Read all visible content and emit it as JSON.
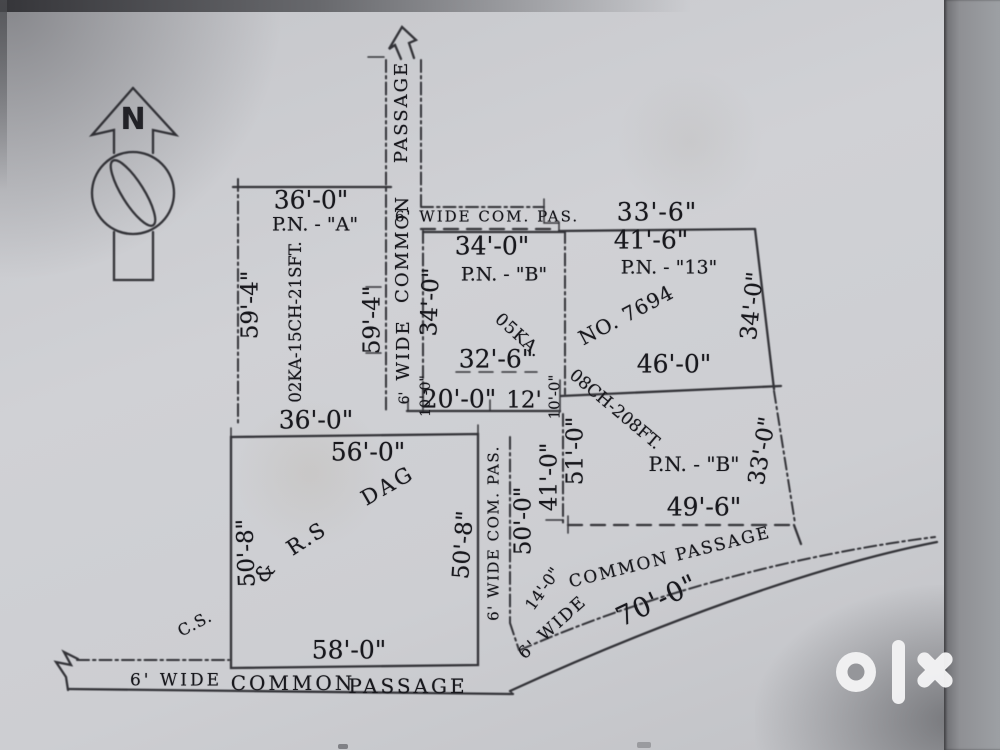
{
  "north": {
    "letter": "N"
  },
  "strip_top": {
    "p1": "PASSAGE",
    "p2": "COMMON",
    "p3": "WIDE",
    "p4": "6'"
  },
  "passage_top": {
    "label": "6' WIDE COM. PAS.",
    "dim": "33'-6\""
  },
  "plot_a": {
    "top": "36'-0\"",
    "name": "P.N. - \"A\"",
    "left": "59'-4\"",
    "area": "02KA-15CH-21SFT.",
    "right": "59'-4\"",
    "bottom": "36'-0\""
  },
  "plot_b1": {
    "top": "34'-0\"",
    "name": "P.N. - \"B\"",
    "left": "34'-0\"",
    "ka": "05KA.",
    "mid": "32'-6\"",
    "b1": "20'-0\"",
    "b2": "12'",
    "s1": "10'-0\"",
    "s2": "10'-0\""
  },
  "plot_13": {
    "top": "41'-6\"",
    "name": "P.N. - \"13\"",
    "no": "NO.  7694",
    "right": "34'-0\"",
    "bottom": "46'-0\""
  },
  "plot_b2": {
    "area": "08CH-208FT.",
    "name": "P.N. - \"B\"",
    "right": "33'-0\"",
    "bottom": "49'-6\"",
    "l1": "51'-0\"",
    "l2": "41'-0\""
  },
  "plot_c": {
    "top": "56'-0\"",
    "dag": "DAG",
    "rs": "R.S",
    "amp": "&",
    "cs": "C.S.",
    "left": "50'-8\"",
    "right": "50'-8\"",
    "bottom": "58'-0\""
  },
  "passage_mid": {
    "label": "6' WIDE COM. PAS.",
    "len": "50'-0\"",
    "w": "14'-0\""
  },
  "passage_diag": {
    "label": "COMMON  PASSAGE",
    "wide": "6'  WIDE",
    "len": "70'-0\""
  },
  "passage_bottom": {
    "w": "6'  WIDE",
    "c": "COMMON",
    "p": "PASSAGE"
  },
  "watermark": {
    "brand": "olx"
  }
}
